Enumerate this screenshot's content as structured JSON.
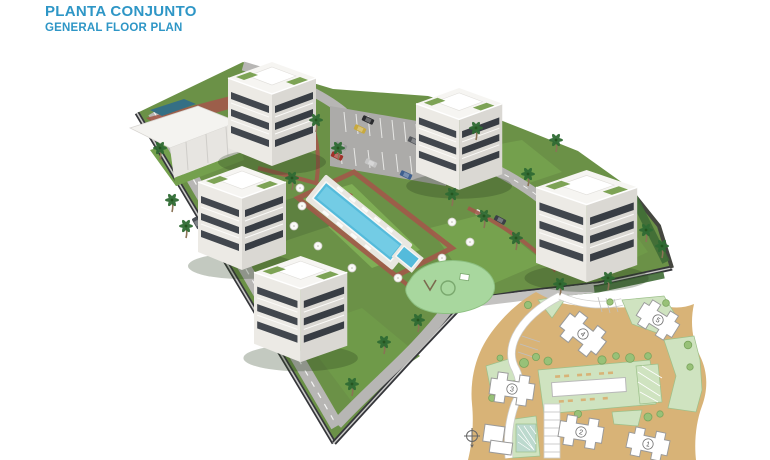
{
  "header": {
    "title": "PLANTA CONJUNTO",
    "subtitle": "GENERAL FLOOR PLAN",
    "accent_color": "#2E96C6"
  },
  "site_render": {
    "type": "3d-aerial-render",
    "apartment_block_count": 5,
    "visible_amenities": [
      "lap-pool",
      "kids-pool",
      "playground",
      "clubhouse",
      "parking-lot",
      "palm-trees",
      "perimeter-wall",
      "internal-roads"
    ]
  },
  "inset_plan": {
    "buildings": [
      {
        "label": "1"
      },
      {
        "label": "2"
      },
      {
        "label": "3"
      },
      {
        "label": "4"
      },
      {
        "label": "5"
      }
    ],
    "compass_icon": "north-compass"
  },
  "colors": {
    "title_blue": "#2E96C6",
    "grass": "#6B9147",
    "road_gray": "#B7B6B4",
    "pool_water": "#55BBDB",
    "paving_red": "#A2594A",
    "inset_tan": "#D8B377",
    "inset_pale_green": "#CFE3C0",
    "playground_green": "#A8D79E",
    "building_white": "#ECEAE5",
    "window_dark": "#42474E"
  }
}
